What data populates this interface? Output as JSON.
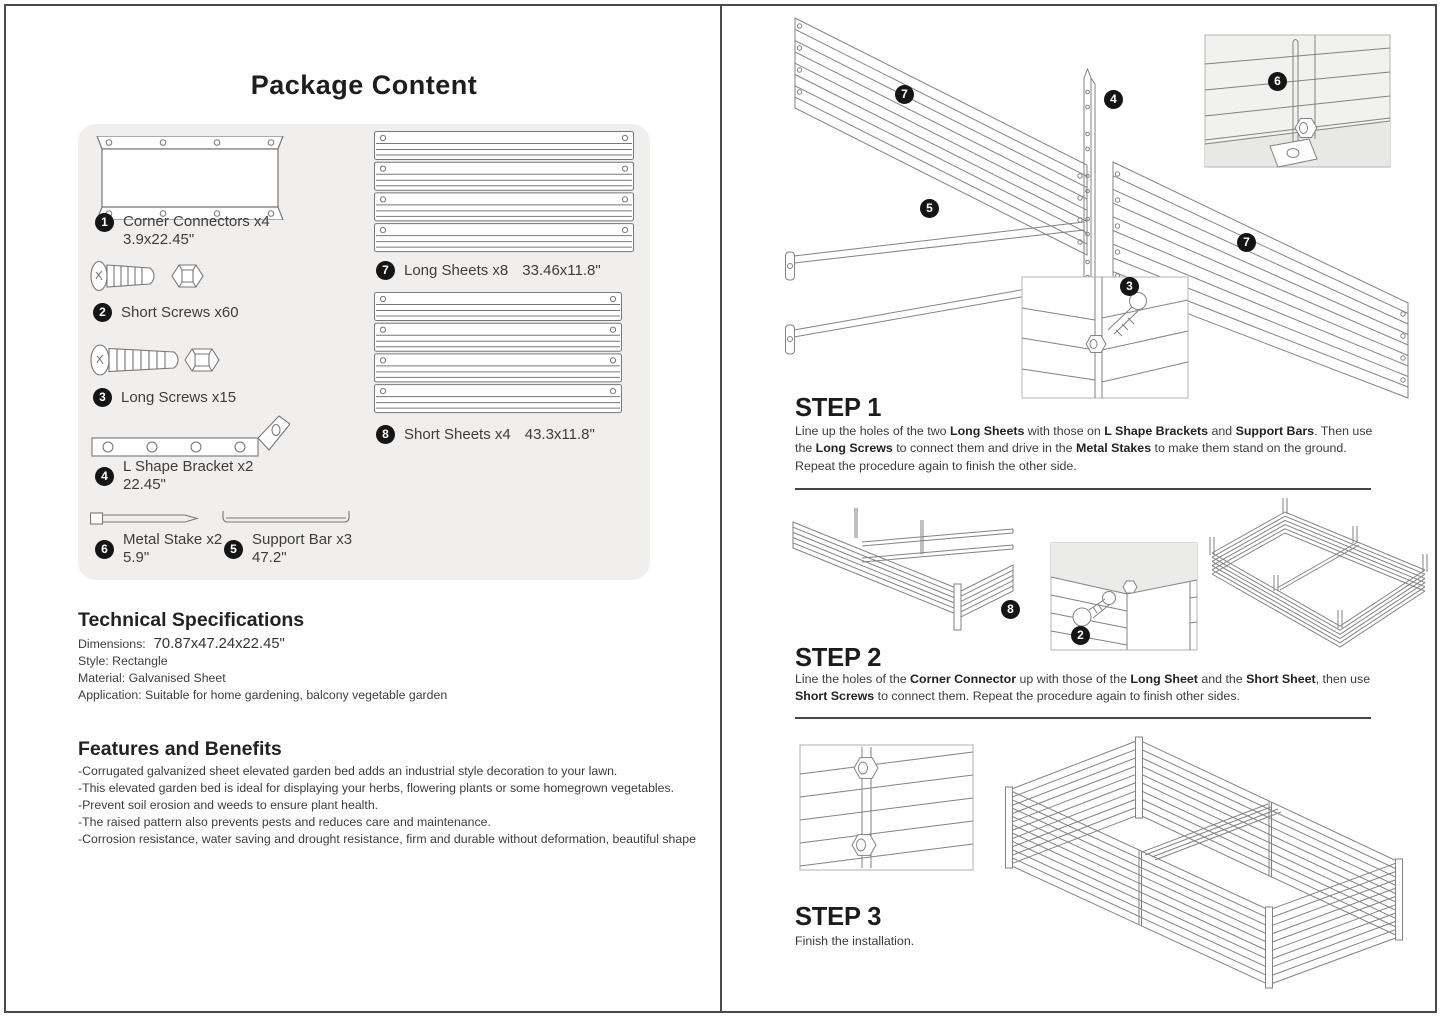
{
  "left": {
    "title": "Package Content",
    "parts": {
      "corner_connectors": {
        "num": "1",
        "name": "Corner Connectors x4",
        "size": "3.9x22.45\""
      },
      "short_screws": {
        "num": "2",
        "name": "Short Screws x60"
      },
      "long_screws": {
        "num": "3",
        "name": "Long Screws x15"
      },
      "l_bracket": {
        "num": "4",
        "name": "L Shape Bracket x2",
        "size": "22.45\""
      },
      "metal_stake": {
        "num": "6",
        "name": "Metal Stake x2",
        "size": "5.9\""
      },
      "support_bar": {
        "num": "5",
        "name": "Support Bar x3",
        "size": "47.2\""
      },
      "long_sheets": {
        "num": "7",
        "name": "Long Sheets x8",
        "size": "33.46x11.8\""
      },
      "short_sheets": {
        "num": "8",
        "name": "Short Sheets x4",
        "size": "43.3x11.8\""
      }
    },
    "tech": {
      "heading": "Technical Specifications",
      "dimensions_label": "Dimensions:",
      "dimensions_value": "70.87x47.24x22.45\"",
      "style": "Style: Rectangle",
      "material": "Material: Galvanised Sheet",
      "application": "Application: Suitable for home gardening, balcony vegetable garden"
    },
    "features": {
      "heading": "Features and Benefits",
      "items": [
        "-Corrugated galvanized sheet elevated garden bed adds an industrial style decoration to your lawn.",
        "-This elevated garden bed is ideal for displaying your herbs, flowering plants or some homegrown vegetables.",
        "-Prevent soil erosion and weeds to ensure plant health.",
        "-The raised pattern also prevents pests and reduces care and maintenance.",
        "-Corrosion resistance, water saving and drought resistance, firm and durable without deformation, beautiful shape"
      ]
    }
  },
  "right": {
    "step1": {
      "title": "STEP 1",
      "segments": [
        {
          "t": "Line up the holes of the two ",
          "b": false
        },
        {
          "t": "Long Sheets",
          "b": true
        },
        {
          "t": " with those on ",
          "b": false
        },
        {
          "t": "L Shape Brackets",
          "b": true
        },
        {
          "t": " and ",
          "b": false
        },
        {
          "t": "Support Bars",
          "b": true
        },
        {
          "t": ". Then use the ",
          "b": false
        },
        {
          "t": "Long Screws",
          "b": true
        },
        {
          "t": " to connect them and drive in the ",
          "b": false
        },
        {
          "t": "Metal Stakes",
          "b": true
        },
        {
          "t": " to make them stand on the ground. Repeat the procedure again to finish the other side.",
          "b": false
        }
      ],
      "callouts": {
        "c7a": "7",
        "c4": "4",
        "c6": "6",
        "c5": "5",
        "c3": "3",
        "c7b": "7"
      }
    },
    "step2": {
      "title": "STEP 2",
      "segments": [
        {
          "t": "Line the holes of the ",
          "b": false
        },
        {
          "t": "Corner Connector",
          "b": true
        },
        {
          "t": " up with those of the ",
          "b": false
        },
        {
          "t": "Long Sheet",
          "b": true
        },
        {
          "t": " and the ",
          "b": false
        },
        {
          "t": "Short Sheet",
          "b": true
        },
        {
          "t": ", then use ",
          "b": false
        },
        {
          "t": "Short Screws",
          "b": true
        },
        {
          "t": " to connect them. Repeat the procedure again to finish other sides.",
          "b": false
        }
      ],
      "callouts": {
        "c8": "8",
        "c2": "2"
      }
    },
    "step3": {
      "title": "STEP 3",
      "segments": [
        {
          "t": "Finish the installation.",
          "b": false
        }
      ]
    }
  }
}
